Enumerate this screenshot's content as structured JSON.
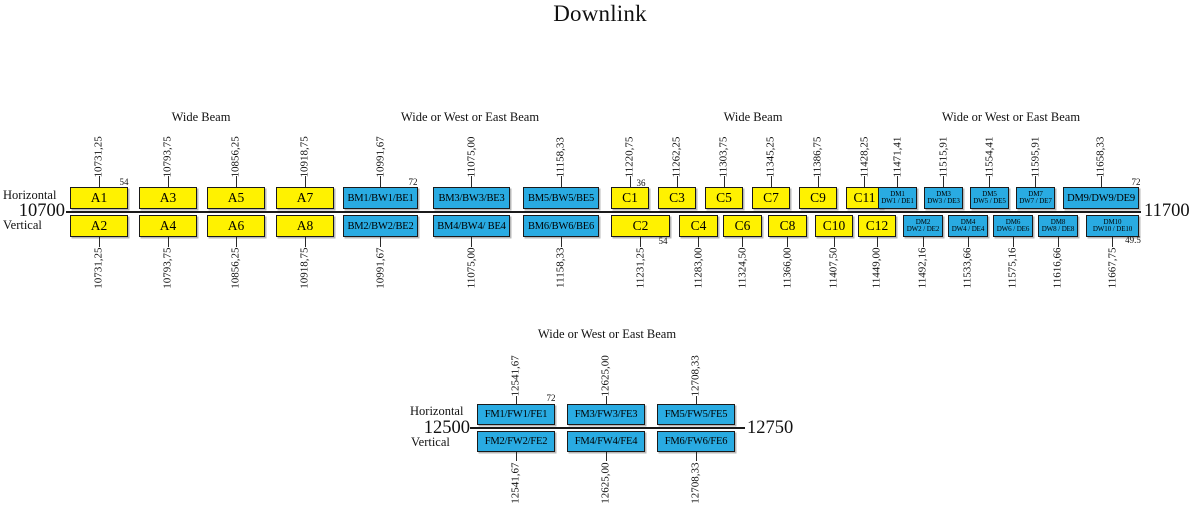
{
  "title": "Downlink",
  "colors": {
    "yellow": "#FFF200",
    "blue": "#29ABE2",
    "line": "#1b1b1b"
  },
  "bands": [
    {
      "start_label": "10700",
      "end_label": "11700",
      "polarization": {
        "top": "Horizontal",
        "bottom": "Vertical"
      },
      "beam_labels": [
        {
          "text": "Wide Beam",
          "x": 201
        },
        {
          "text": "Wide or West or East Beam",
          "x": 470
        },
        {
          "text": "Wide Beam",
          "x": 753
        },
        {
          "text": "Wide or West or East Beam",
          "x": 1011
        }
      ],
      "top_channels": [
        {
          "label": "A1",
          "freq": "10731,25",
          "color": "yellow",
          "cls": "lg",
          "x": 70,
          "w": 58
        },
        {
          "label": "A3",
          "freq": "10793,75",
          "color": "yellow",
          "cls": "lg",
          "x": 139,
          "w": 58
        },
        {
          "label": "A5",
          "freq": "10856,25",
          "color": "yellow",
          "cls": "lg",
          "x": 207,
          "w": 58
        },
        {
          "label": "A7",
          "freq": "10918,75",
          "color": "yellow",
          "cls": "lg",
          "x": 276,
          "w": 58
        },
        {
          "label": "BM1/BW1/BE1",
          "freq": "10991,67",
          "color": "blue",
          "cls": "md",
          "x": 343,
          "w": 75
        },
        {
          "label": "BM3/BW3/BE3",
          "freq": "11075,00",
          "color": "blue",
          "cls": "md",
          "x": 433,
          "w": 77
        },
        {
          "label": "BM5/BW5/BE5",
          "freq": "11158,33",
          "color": "blue",
          "cls": "md",
          "x": 523,
          "w": 76
        },
        {
          "label": "C1",
          "freq": "11220,75",
          "color": "yellow",
          "cls": "lg",
          "x": 611,
          "w": 38
        },
        {
          "label": "C3",
          "freq": "11262,25",
          "color": "yellow",
          "cls": "lg",
          "x": 658,
          "w": 38
        },
        {
          "label": "C5",
          "freq": "11303,75",
          "color": "yellow",
          "cls": "lg",
          "x": 705,
          "w": 38
        },
        {
          "label": "C7",
          "freq": "11345,25",
          "color": "yellow",
          "cls": "lg",
          "x": 752,
          "w": 38
        },
        {
          "label": "C9",
          "freq": "11386,75",
          "color": "yellow",
          "cls": "lg",
          "x": 799,
          "w": 38
        },
        {
          "label": "C11",
          "freq": "11428,25",
          "color": "yellow",
          "cls": "lg",
          "x": 846,
          "w": 37
        },
        {
          "label": "DM1|DW1 / DE1",
          "freq": "11471,41",
          "color": "blue",
          "cls": "sm2",
          "x": 878,
          "w": 39
        },
        {
          "label": "DM3|DW3 / DE3",
          "freq": "11515,91",
          "color": "blue",
          "cls": "sm2",
          "x": 924,
          "w": 39
        },
        {
          "label": "DM5|DW5 / DE5",
          "freq": "11554,41",
          "color": "blue",
          "cls": "sm2",
          "x": 970,
          "w": 39
        },
        {
          "label": "DM7|DW7 / DE7",
          "freq": "11595,91",
          "color": "blue",
          "cls": "sm2",
          "x": 1016,
          "w": 39
        },
        {
          "label": "DM9/DW9/DE9",
          "freq": "11658,33",
          "color": "blue",
          "cls": "md",
          "x": 1063,
          "w": 76
        }
      ],
      "bottom_channels": [
        {
          "label": "A2",
          "freq": "10731,25",
          "color": "yellow",
          "cls": "lg",
          "x": 70,
          "w": 58
        },
        {
          "label": "A4",
          "freq": "10793,75",
          "color": "yellow",
          "cls": "lg",
          "x": 139,
          "w": 58
        },
        {
          "label": "A6",
          "freq": "10856,25",
          "color": "yellow",
          "cls": "lg",
          "x": 207,
          "w": 58
        },
        {
          "label": "A8",
          "freq": "10918,75",
          "color": "yellow",
          "cls": "lg",
          "x": 276,
          "w": 58
        },
        {
          "label": "BM2/BW2/BE2",
          "freq": "10991,67",
          "color": "blue",
          "cls": "md",
          "x": 343,
          "w": 75
        },
        {
          "label": "BM4/BW4/ BE4",
          "freq": "11075,00",
          "color": "blue",
          "cls": "md",
          "x": 433,
          "w": 77
        },
        {
          "label": "BM6/BW6/BE6",
          "freq": "11158,33",
          "color": "blue",
          "cls": "md",
          "x": 523,
          "w": 76
        },
        {
          "label": "C2",
          "freq": "11231,25",
          "color": "yellow",
          "cls": "lg",
          "x": 611,
          "w": 59
        },
        {
          "label": "C4",
          "freq": "11283,00",
          "color": "yellow",
          "cls": "lg",
          "x": 679,
          "w": 39
        },
        {
          "label": "C6",
          "freq": "11324,50",
          "color": "yellow",
          "cls": "lg",
          "x": 723,
          "w": 39
        },
        {
          "label": "C8",
          "freq": "11366,00",
          "color": "yellow",
          "cls": "lg",
          "x": 768,
          "w": 39
        },
        {
          "label": "C10",
          "freq": "11407,50",
          "color": "yellow",
          "cls": "lg",
          "x": 815,
          "w": 38
        },
        {
          "label": "C12",
          "freq": "11449,00",
          "color": "yellow",
          "cls": "lg",
          "x": 858,
          "w": 38
        },
        {
          "label": "DM2|DW2 / DE2",
          "freq": "11492,16",
          "color": "blue",
          "cls": "sm2",
          "x": 903,
          "w": 40
        },
        {
          "label": "DM4|DW4 / DE4",
          "freq": "11533,66",
          "color": "blue",
          "cls": "sm2",
          "x": 948,
          "w": 40
        },
        {
          "label": "DM6|DW6 / DE6",
          "freq": "11575,16",
          "color": "blue",
          "cls": "sm2",
          "x": 993,
          "w": 40
        },
        {
          "label": "DM8|DW8 / DE8",
          "freq": "11616,66",
          "color": "blue",
          "cls": "sm2",
          "x": 1038,
          "w": 40
        },
        {
          "label": "DM10|DW10 / DE10",
          "freq": "11667,75",
          "color": "blue",
          "cls": "sm2",
          "x": 1086,
          "w": 53
        }
      ],
      "bandwidth_notes": [
        {
          "text": "54",
          "x": 124,
          "y": 177
        },
        {
          "text": "72",
          "x": 413,
          "y": 177
        },
        {
          "text": "36",
          "x": 641,
          "y": 178
        },
        {
          "text": "72",
          "x": 1136,
          "y": 177
        },
        {
          "text": "54",
          "x": 663,
          "y": 236
        },
        {
          "text": "49.5",
          "x": 1133,
          "y": 235
        }
      ]
    },
    {
      "start_label": "12500",
      "end_label": "12750",
      "polarization": {
        "top": "Horizontal",
        "bottom": "Vertical"
      },
      "beam_labels": [
        {
          "text": "Wide or West or East Beam",
          "x": 607
        }
      ],
      "top_channels": [
        {
          "label": "FM1/FW1/FE1",
          "freq": "12541,67",
          "color": "blue",
          "cls": "md",
          "x": 477,
          "w": 78
        },
        {
          "label": "FM3/FW3/FE3",
          "freq": "12625,00",
          "color": "blue",
          "cls": "md",
          "x": 567,
          "w": 78
        },
        {
          "label": "FM5/FW5/FE5",
          "freq": "12708,33",
          "color": "blue",
          "cls": "md",
          "x": 657,
          "w": 78
        }
      ],
      "bottom_channels": [
        {
          "label": "FM2/FW2/FE2",
          "freq": "12541,67",
          "color": "blue",
          "cls": "md",
          "x": 477,
          "w": 78
        },
        {
          "label": "FM4/FW4/FE4",
          "freq": "12625,00",
          "color": "blue",
          "cls": "md",
          "x": 567,
          "w": 78
        },
        {
          "label": "FM6/FW6/FE6",
          "freq": "12708,33",
          "color": "blue",
          "cls": "md",
          "x": 657,
          "w": 78
        }
      ],
      "bandwidth_notes": [
        {
          "text": "72",
          "x": 551,
          "y": 393
        }
      ]
    }
  ]
}
